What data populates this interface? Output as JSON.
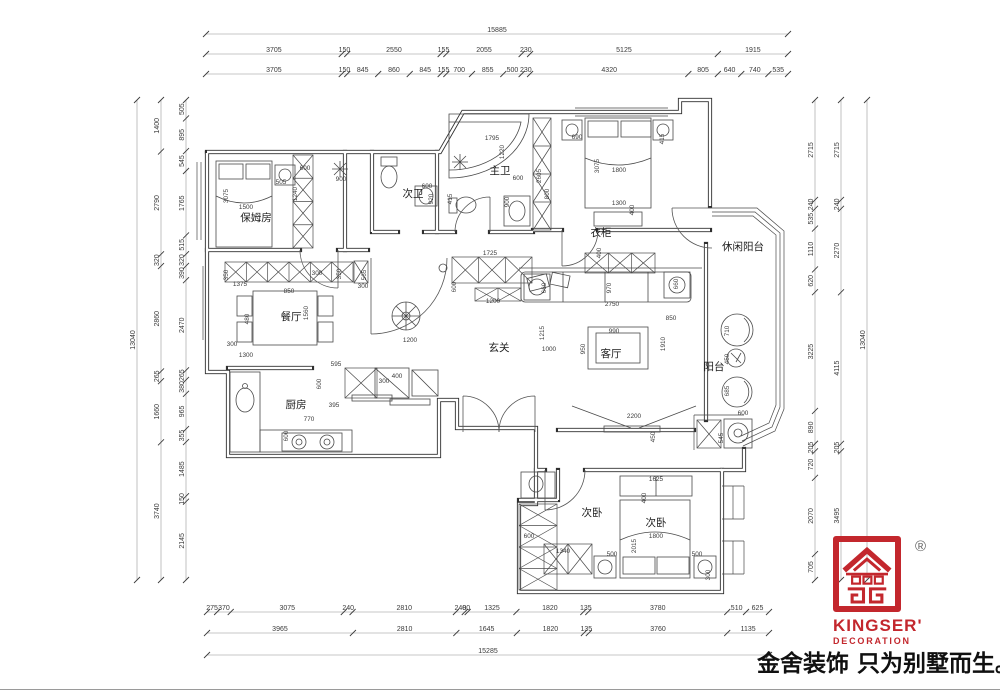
{
  "logo": {
    "brand": "KINGSER'",
    "subtitle": "DECORATION",
    "registered": "®",
    "color": "#c3272d"
  },
  "slogan": "金舍装饰 只为别墅而生。",
  "dimensions": {
    "top": {
      "total": [
        15885
      ],
      "row2": [
        3705,
        150,
        2550,
        155,
        2055,
        230,
        5125,
        1915
      ],
      "row3": [
        3705,
        150,
        845,
        860,
        845,
        155,
        700,
        855,
        500,
        230,
        4320,
        805,
        640,
        740,
        535
      ]
    },
    "bottom": {
      "row1": [
        275,
        370,
        3075,
        240,
        2810,
        240,
        80,
        1325,
        1820,
        135,
        3780,
        510,
        625
      ],
      "row2": [
        3965,
        2810,
        1645,
        1820,
        135,
        3760,
        1135
      ],
      "total": [
        15285
      ]
    },
    "left": {
      "inner": [
        505,
        895,
        545,
        1765,
        515,
        320,
        390,
        2470,
        265,
        380,
        965,
        355,
        1485,
        150,
        2145
      ],
      "middle": [
        1400,
        2790,
        320,
        2860,
        265,
        1660,
        3740
      ],
      "total": [
        13040
      ]
    },
    "right": {
      "inner": [
        2715,
        240,
        535,
        1110,
        620,
        3225,
        890,
        205,
        720,
        2070,
        705
      ],
      "middle": [
        2715,
        240,
        2270,
        4115,
        205,
        3495
      ],
      "total": [
        13040
      ]
    }
  },
  "rooms": [
    {
      "label": "保姆房",
      "x": 256,
      "y": 221
    },
    {
      "label": "次卫",
      "x": 413,
      "y": 197
    },
    {
      "label": "主卫",
      "x": 500,
      "y": 174
    },
    {
      "label": "衣柜",
      "x": 601,
      "y": 236
    },
    {
      "label": "休闲阳台",
      "x": 743,
      "y": 250
    },
    {
      "label": "餐厅",
      "x": 291,
      "y": 320
    },
    {
      "label": "玄关",
      "x": 499,
      "y": 351
    },
    {
      "label": "客厅",
      "x": 611,
      "y": 357
    },
    {
      "label": "阳台",
      "x": 714,
      "y": 370
    },
    {
      "label": "厨房",
      "x": 296,
      "y": 408
    },
    {
      "label": "次卧",
      "x": 592,
      "y": 516
    },
    {
      "label": "次卧",
      "x": 656,
      "y": 526
    }
  ],
  "annotations": [
    [
      228,
      196,
      1,
      "3075"
    ],
    [
      246,
      209,
      0,
      "1500"
    ],
    [
      281,
      184,
      0,
      "505"
    ],
    [
      305,
      170,
      0,
      "600"
    ],
    [
      341,
      181,
      0,
      "900"
    ],
    [
      297,
      194,
      1,
      "1240"
    ],
    [
      427,
      188,
      0,
      "600"
    ],
    [
      433,
      199,
      1,
      "920"
    ],
    [
      452,
      199,
      1,
      "415"
    ],
    [
      492,
      140,
      0,
      "1795"
    ],
    [
      504,
      152,
      1,
      "1220"
    ],
    [
      518,
      180,
      0,
      "600"
    ],
    [
      509,
      202,
      1,
      "900"
    ],
    [
      541,
      176,
      1,
      "2605"
    ],
    [
      549,
      194,
      1,
      "800"
    ],
    [
      577,
      139,
      0,
      "690"
    ],
    [
      599,
      166,
      1,
      "3075"
    ],
    [
      619,
      172,
      0,
      "1800"
    ],
    [
      619,
      205,
      0,
      "1300"
    ],
    [
      634,
      210,
      1,
      "400"
    ],
    [
      664,
      139,
      1,
      "415"
    ],
    [
      601,
      253,
      1,
      "400"
    ],
    [
      546,
      288,
      1,
      "660"
    ],
    [
      678,
      284,
      1,
      "660"
    ],
    [
      611,
      288,
      1,
      "970"
    ],
    [
      612,
      306,
      0,
      "2750"
    ],
    [
      671,
      320,
      0,
      "850"
    ],
    [
      665,
      344,
      1,
      "1910"
    ],
    [
      614,
      333,
      0,
      "990"
    ],
    [
      585,
      349,
      1,
      "950"
    ],
    [
      544,
      333,
      1,
      "1215"
    ],
    [
      549,
      351,
      0,
      "1000"
    ],
    [
      490,
      255,
      0,
      "1725"
    ],
    [
      493,
      303,
      0,
      "1200"
    ],
    [
      456,
      287,
      1,
      "600"
    ],
    [
      410,
      342,
      0,
      "1200"
    ],
    [
      240,
      286,
      0,
      "1375"
    ],
    [
      228,
      275,
      1,
      "350"
    ],
    [
      289,
      293,
      0,
      "850"
    ],
    [
      317,
      275,
      0,
      "300"
    ],
    [
      341,
      274,
      1,
      "350"
    ],
    [
      249,
      319,
      1,
      "480"
    ],
    [
      308,
      313,
      1,
      "1560"
    ],
    [
      366,
      275,
      1,
      "565"
    ],
    [
      363,
      288,
      0,
      "300"
    ],
    [
      232,
      346,
      0,
      "300"
    ],
    [
      246,
      357,
      0,
      "1300"
    ],
    [
      336,
      366,
      0,
      "595"
    ],
    [
      321,
      384,
      1,
      "600"
    ],
    [
      334,
      407,
      0,
      "395"
    ],
    [
      309,
      421,
      0,
      "770"
    ],
    [
      288,
      436,
      1,
      "600"
    ],
    [
      384,
      383,
      0,
      "300"
    ],
    [
      397,
      378,
      0,
      "400"
    ],
    [
      634,
      418,
      0,
      "2200"
    ],
    [
      655,
      437,
      1,
      "450"
    ],
    [
      743,
      415,
      0,
      "600"
    ],
    [
      723,
      438,
      1,
      "545"
    ],
    [
      656,
      481,
      0,
      "1625"
    ],
    [
      646,
      498,
      1,
      "400"
    ],
    [
      656,
      538,
      0,
      "1800"
    ],
    [
      636,
      546,
      1,
      "2015"
    ],
    [
      612,
      556,
      0,
      "500"
    ],
    [
      697,
      556,
      0,
      "500"
    ],
    [
      710,
      575,
      1,
      "300"
    ],
    [
      563,
      553,
      0,
      "1340"
    ],
    [
      529,
      538,
      0,
      "600"
    ],
    [
      729,
      331,
      1,
      "710"
    ],
    [
      729,
      359,
      1,
      "450"
    ],
    [
      729,
      391,
      1,
      "685"
    ]
  ]
}
